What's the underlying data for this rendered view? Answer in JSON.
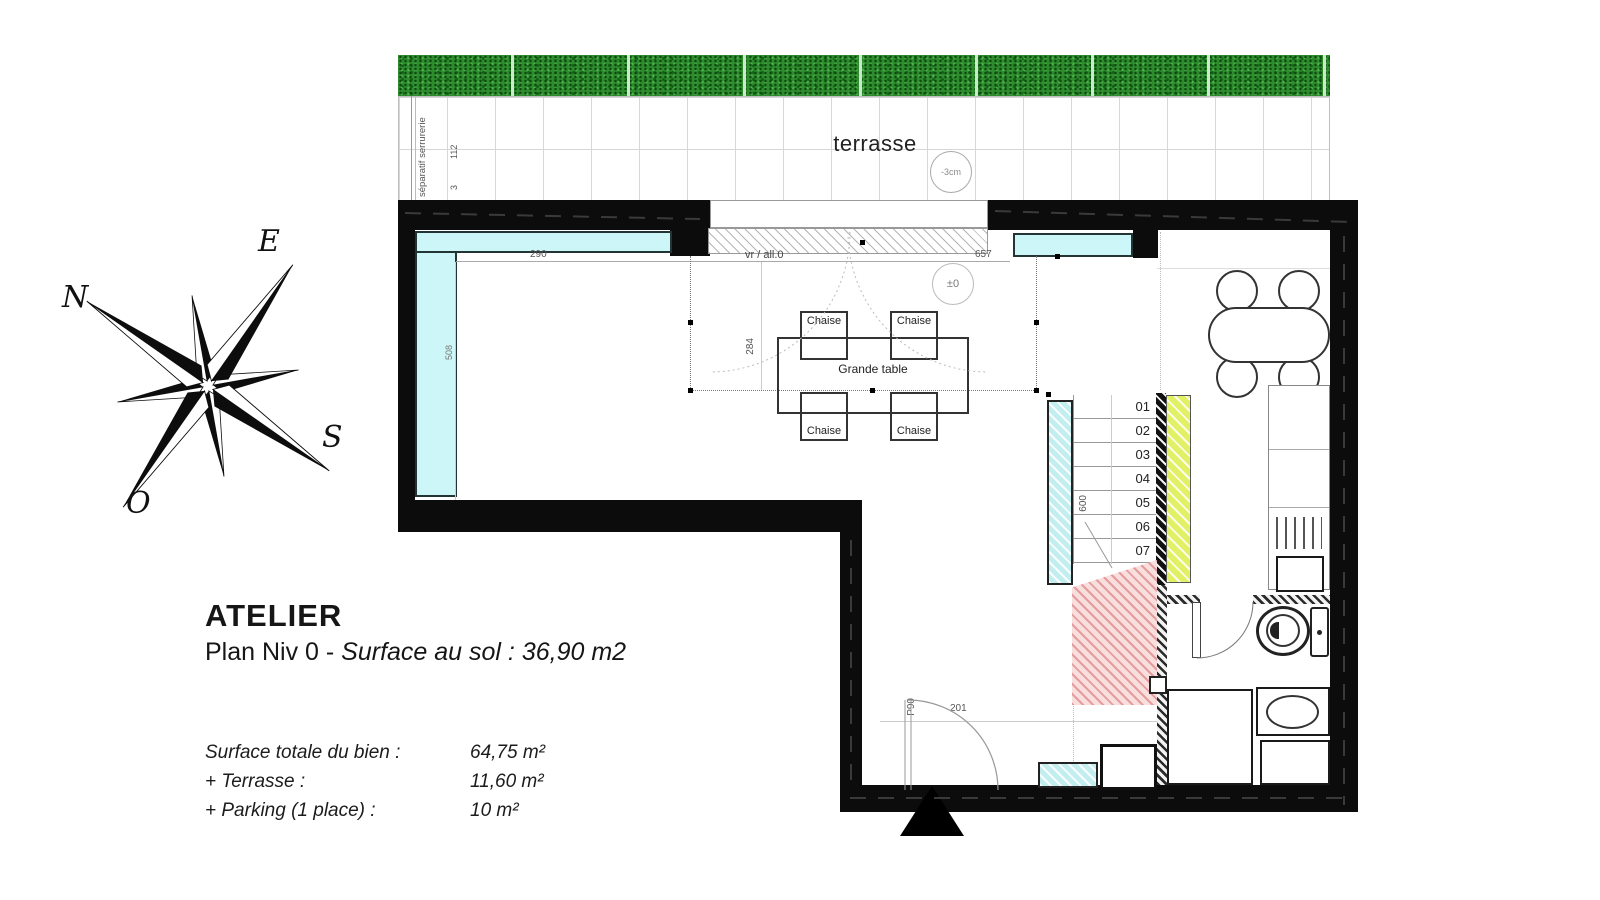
{
  "title_block": {
    "title": "ATELIER",
    "subtitle_plain": "Plan Niv 0 - ",
    "subtitle_italic": "Surface au sol : 36,90 m2",
    "surface_rows": [
      {
        "label": "Surface totale du bien :",
        "value": "64,75 m²"
      },
      {
        "label": "+ Terrasse :",
        "value": "11,60 m²"
      },
      {
        "label": "+ Parking (1 place) :",
        "value": "10 m²"
      }
    ]
  },
  "compass": {
    "north": "N",
    "east": "E",
    "south": "S",
    "west": "O"
  },
  "terrace": {
    "label": "terrasse",
    "level_badge": "-3cm",
    "separator_label": "séparatif serrurerie",
    "dim_height": "112",
    "dim_gap": "3"
  },
  "plan": {
    "opening_label": "vr / all.0",
    "level_badge": "±0",
    "dim_top_left": "290",
    "dim_top_right": "657",
    "dim_table": "284",
    "dim_left_wall": "508",
    "dim_stairs": "600",
    "dim_door": "201",
    "door_label": "P90",
    "table_label": "Grande table",
    "chair_label": "Chaise",
    "stair_steps": [
      "01",
      "02",
      "03",
      "04",
      "05",
      "06",
      "07"
    ]
  },
  "colors": {
    "wall": "#0c0c0c",
    "glazing_cyan": "#cdf6f8",
    "stair_core_yellow": "#e2f066",
    "understair_red": "#f9dede",
    "hedge_green": "#2e8b2e"
  }
}
